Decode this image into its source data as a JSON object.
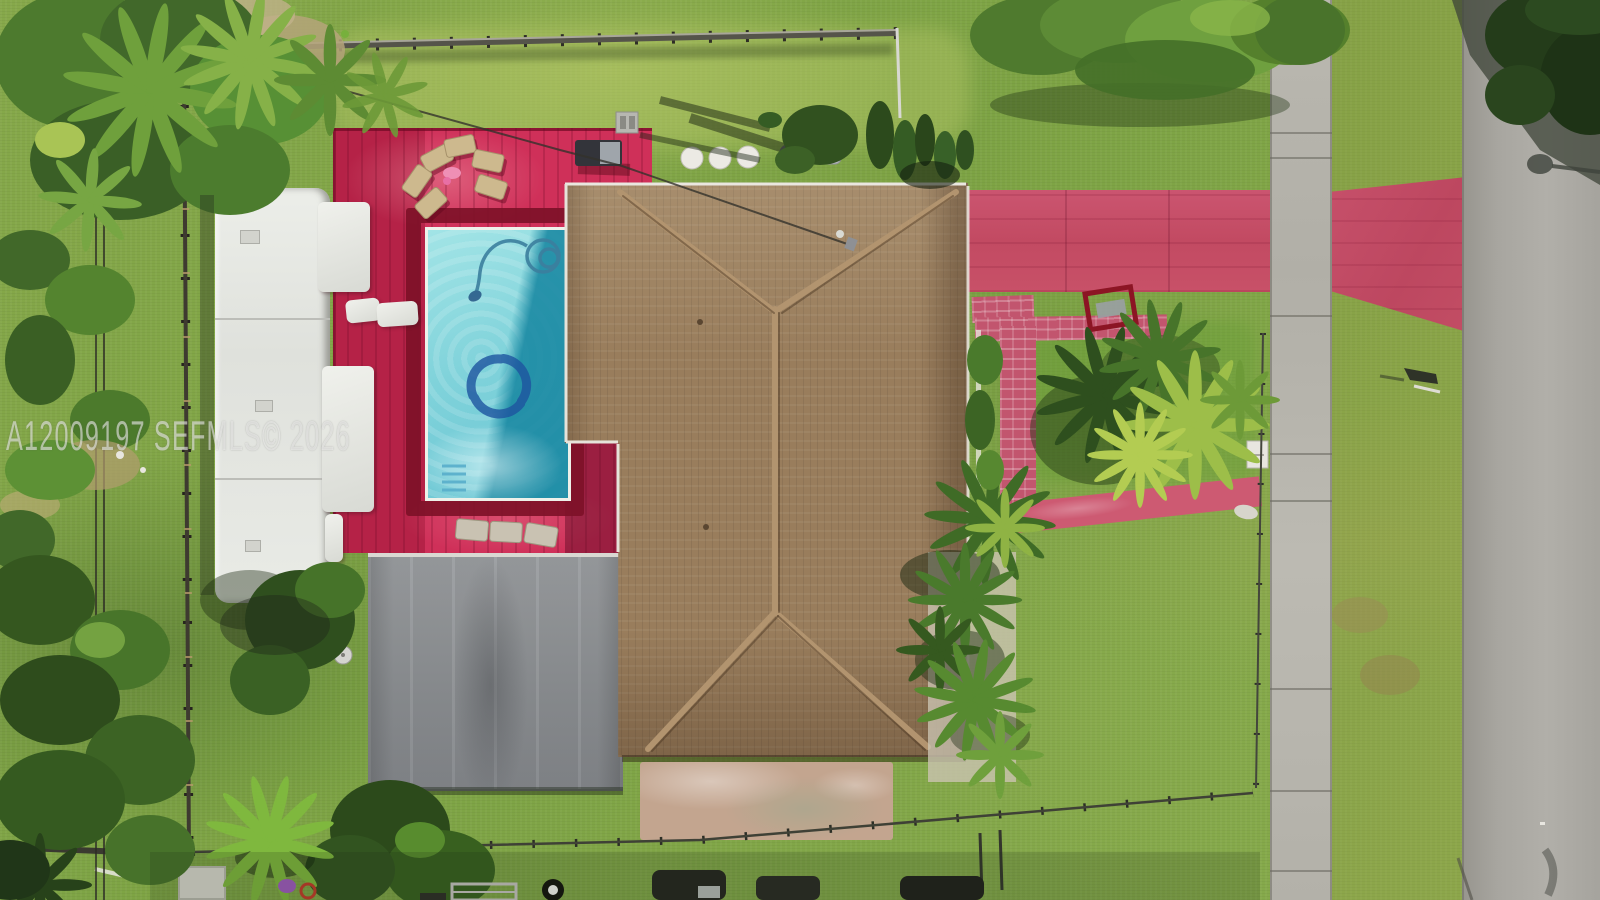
{
  "watermark": {
    "text": "A12009197 SEFMLS© 2026"
  },
  "scene": {
    "type": "aerial-drone-photo",
    "description": "Top-down drone view of a single-family residential lot: brown hip-shingle roof house, bright pink wooden pool deck with rectangular pool (dolphin mosaic), tan lounge chairs, white RV trailer parked along the west fence, gray flat carport roof, pink painted driveway and brick walkways, front lawn with palm clusters, concrete sidewalk, grass verge and asphalt road on the right, tree canopies top-left, top-center and over the road top-right.",
    "objects": [
      "house-roof",
      "flat-carport-roof",
      "swimming-pool",
      "pool-dolphin-motif",
      "pool-cleaner-hose",
      "pool-steps",
      "pool-deck",
      "lounge-chairs",
      "grill",
      "rv-trailer",
      "storage-boxes",
      "driveway",
      "driveway-apron",
      "brick-walkways",
      "front-walk",
      "patio-slab",
      "sidewalk",
      "road",
      "front-palm-cluster",
      "side-palm-bed",
      "backyard-cacti",
      "tree-canopies",
      "chain-link-fences",
      "power-lines",
      "service-cable",
      "street-sign",
      "ac-unit",
      "neighbor-vehicles",
      "sheds",
      "watermark"
    ],
    "palette": {
      "deck_pink": "#cf3059",
      "deck_dark_border": "#7e1128",
      "pool_aqua": "#7fd2da",
      "pool_deep_teal": "#1888a2",
      "pool_motif_blue": "#1e55a0",
      "roof_brown": "#997d5c",
      "flat_roof_gray": "#8e9194",
      "grass_green": "#83a648",
      "driveway_pink": "#c24a62",
      "sidewalk_concrete": "#b6b4ac",
      "road_asphalt": "#a5a39e",
      "rv_white": "#e8e9e6",
      "patio_tan": "#c3a58f",
      "tree_dark": "#2e4f1e",
      "palm_bright": "#9dbe49"
    }
  }
}
